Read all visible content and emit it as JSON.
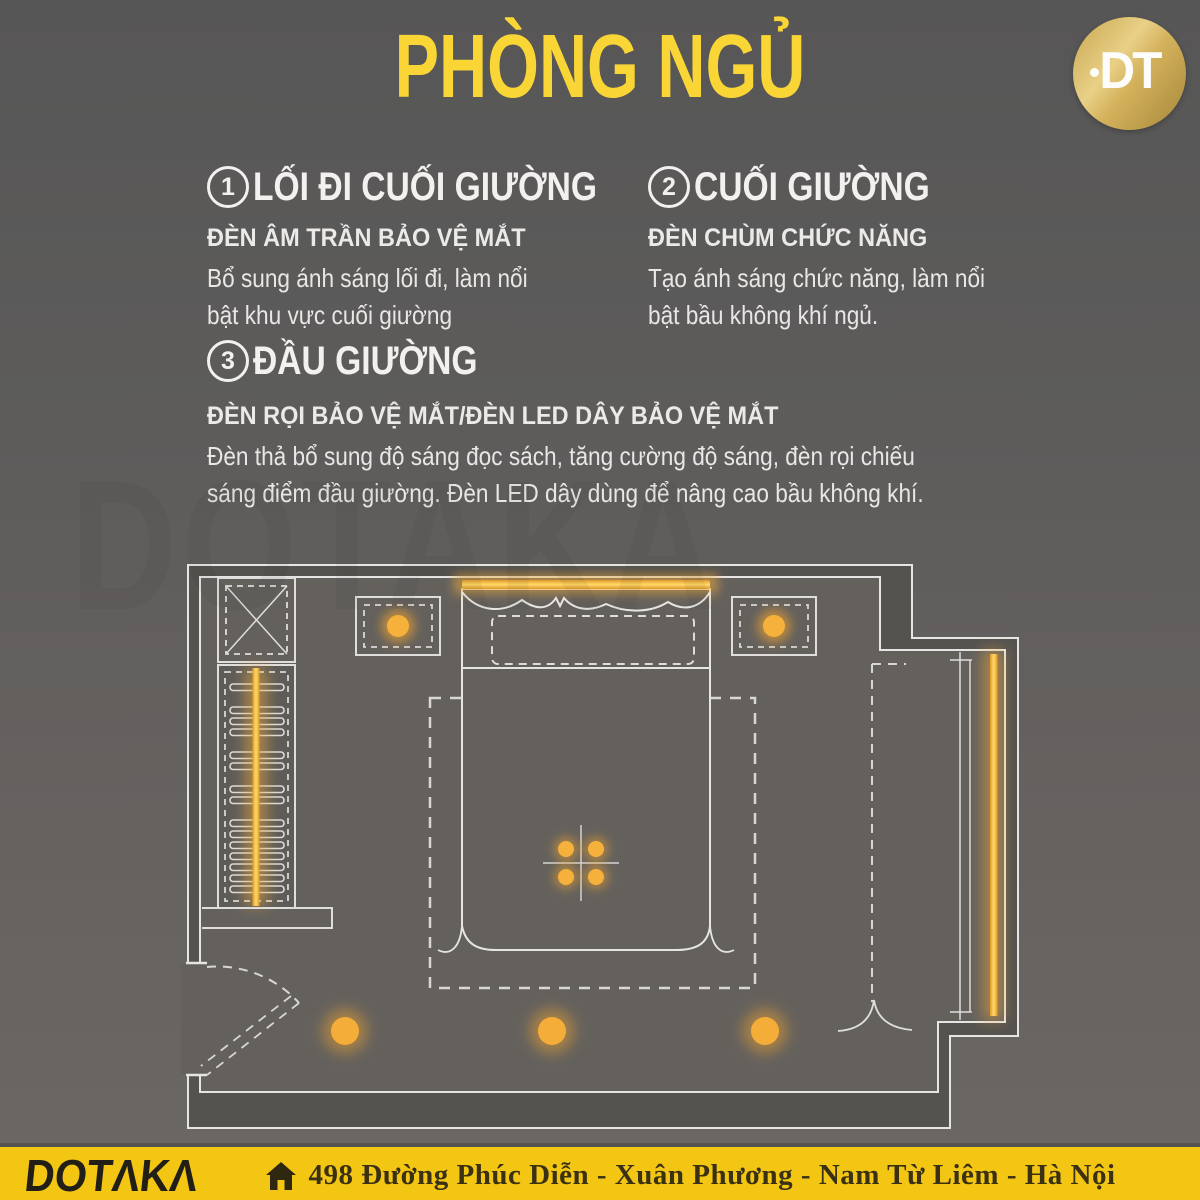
{
  "header": {
    "title": "PHÒNG NGỦ",
    "title_color": "#f9d636",
    "logo_text": "DT"
  },
  "sections": [
    {
      "number": "1",
      "title": "LỐI ĐI CUỐI GIƯỜNG",
      "subtitle": "ĐÈN ÂM TRẦN BẢO VỆ MẮT",
      "body_lines": [
        "Bổ sung ánh sáng lối đi, làm nổi",
        "bật khu vực cuối giường"
      ]
    },
    {
      "number": "2",
      "title": "CUỐI GIƯỜNG",
      "subtitle": "ĐÈN CHÙM CHỨC NĂNG",
      "body_lines": [
        "Tạo ánh sáng chức năng, làm nổi",
        "bật bầu không khí ngủ."
      ]
    },
    {
      "number": "3",
      "title": "ĐẦU GIƯỜNG",
      "subtitle": "ĐÈN RỌI BẢO VỆ MẮT/ĐÈN LED DÂY BẢO VỆ MẮT",
      "body_lines": [
        "Đèn thả bổ sung độ sáng đọc sách, tăng cường độ sáng, đèn rọi chiếu",
        "sáng điểm đầu giường. Đèn LED dây dùng để nâng cao bầu không khí."
      ]
    }
  ],
  "floor_plan": {
    "type": "bedroom-lighting-plan",
    "accent_color": "#f3ab38",
    "wall_color": "#e6e5e3",
    "elements": [
      "wardrobe-x-box",
      "wardrobe-shelves-led-strip",
      "recessed-downlight-left-nightstand",
      "recessed-downlight-right-nightstand",
      "bed-headboard-led-strip",
      "bed",
      "pillow-zone",
      "rug-outline",
      "ceiling-chandelier-4-bulbs",
      "walkway-downlight-1",
      "walkway-downlight-2",
      "walkway-downlight-3",
      "entry-door-swing",
      "bay-window-led-strip",
      "curtain-zone"
    ]
  },
  "watermark": "DOTAKA",
  "footer": {
    "brand": "DOTAKA",
    "brand_display": "DOTΛKΛ",
    "address": "498 Đường Phúc Diễn - Xuân Phương - Nam Từ Liêm - Hà Nội",
    "bg_color": "#f4c614"
  }
}
